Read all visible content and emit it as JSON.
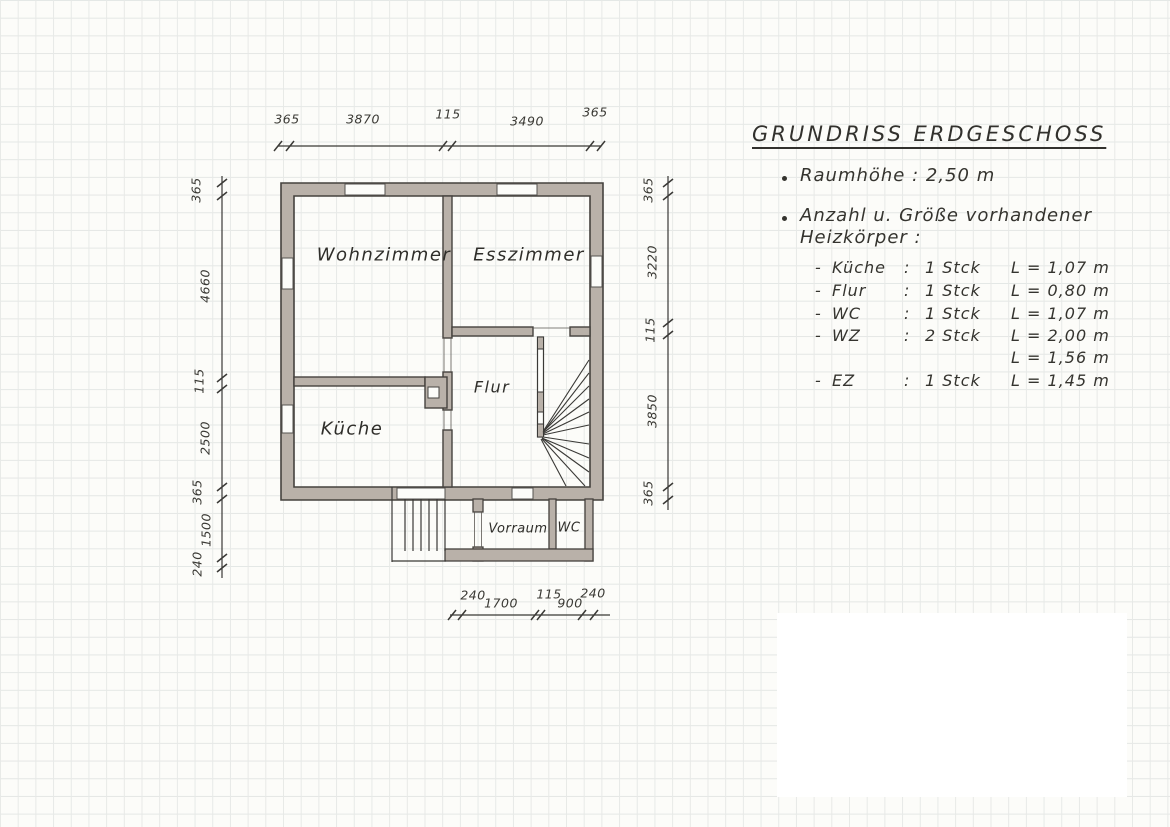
{
  "title": "GRUNDRISS ERDGESCHOSS",
  "notes": {
    "raumhoehe": "Raumhöhe : 2,50 m",
    "anzahl_line1": "Anzahl u. Größe vorhandener",
    "anzahl_line2": "Heizkörper :"
  },
  "heizkoerper": {
    "rows": [
      {
        "dash": "-",
        "room": "Küche",
        "colon": ":",
        "count": "1 Stck",
        "length": "L = 1,07 m"
      },
      {
        "dash": "-",
        "room": "Flur",
        "colon": ":",
        "count": "1 Stck",
        "length": "L = 0,80 m"
      },
      {
        "dash": "-",
        "room": "WC",
        "colon": ":",
        "count": "1 Stck",
        "length": "L = 1,07 m"
      },
      {
        "dash": "-",
        "room": "WZ",
        "colon": ":",
        "count": "2 Stck",
        "length": "L = 2,00 m"
      },
      {
        "dash": "",
        "room": "",
        "colon": "",
        "count": "",
        "length": "L = 1,56 m"
      },
      {
        "dash": "-",
        "room": "EZ",
        "colon": ":",
        "count": "1 Stck",
        "length": "L = 1,45 m"
      }
    ]
  },
  "plan": {
    "rooms": {
      "wohnzimmer": "Wohnzimmer",
      "esszimmer": "Esszimmer",
      "flur": "Flur",
      "kueche": "Küche",
      "vorraum": "Vorraum",
      "wc": "WC"
    },
    "dimensions": {
      "top": [
        "365",
        "3870",
        "115",
        "3490",
        "365"
      ],
      "left": [
        "365",
        "4660",
        "115",
        "2500",
        "365",
        "1500",
        "240"
      ],
      "right": [
        "365",
        "3220",
        "115",
        "3850",
        "365"
      ],
      "bottom": [
        "240",
        "1700",
        "115",
        "900",
        "240"
      ]
    }
  },
  "colors": {
    "ink": "#3a3936",
    "wall_fill": "#b9b1a9",
    "paper": "#fcfcf9"
  }
}
